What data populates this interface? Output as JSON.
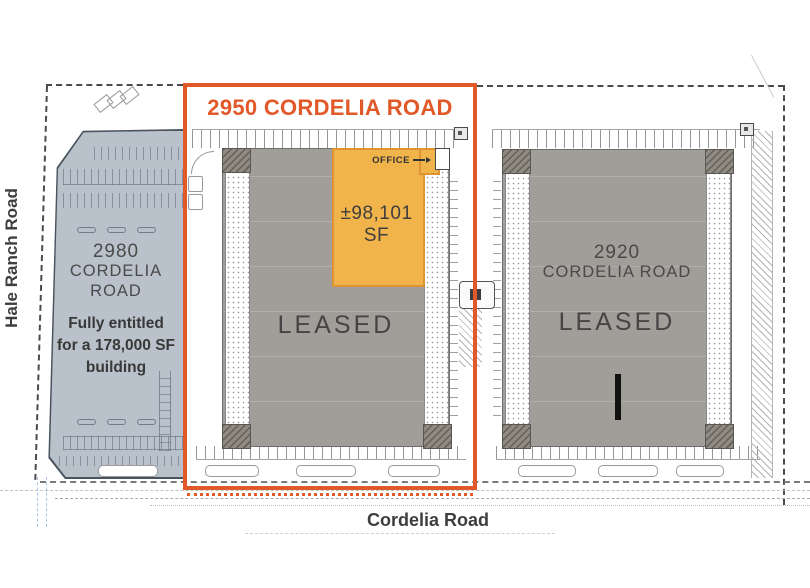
{
  "callout": {
    "title": "2950 CORDELIA ROAD",
    "office_label": "OFFICE",
    "available_sf": "±98,101 SF",
    "status": "LEASED"
  },
  "building_2980": {
    "address_line1": "2980",
    "address_line2": "CORDELIA",
    "address_line3": "ROAD",
    "note_line1": "Fully entitled",
    "note_line2": "for a 178,000 SF",
    "note_line3": "building"
  },
  "building_2920": {
    "address_line1": "2920",
    "address_line2": "CORDELIA ROAD",
    "status": "LEASED"
  },
  "roads": {
    "west": "Hale Ranch Road",
    "south": "Cordelia Road"
  },
  "colors": {
    "accent": "#E15829",
    "office_fill": "#F1B44B",
    "office_border": "#DE9434",
    "building_gray": "#A19D98",
    "entitled_fill": "#B9C2CA",
    "text_dark": "#3E3E3E"
  }
}
